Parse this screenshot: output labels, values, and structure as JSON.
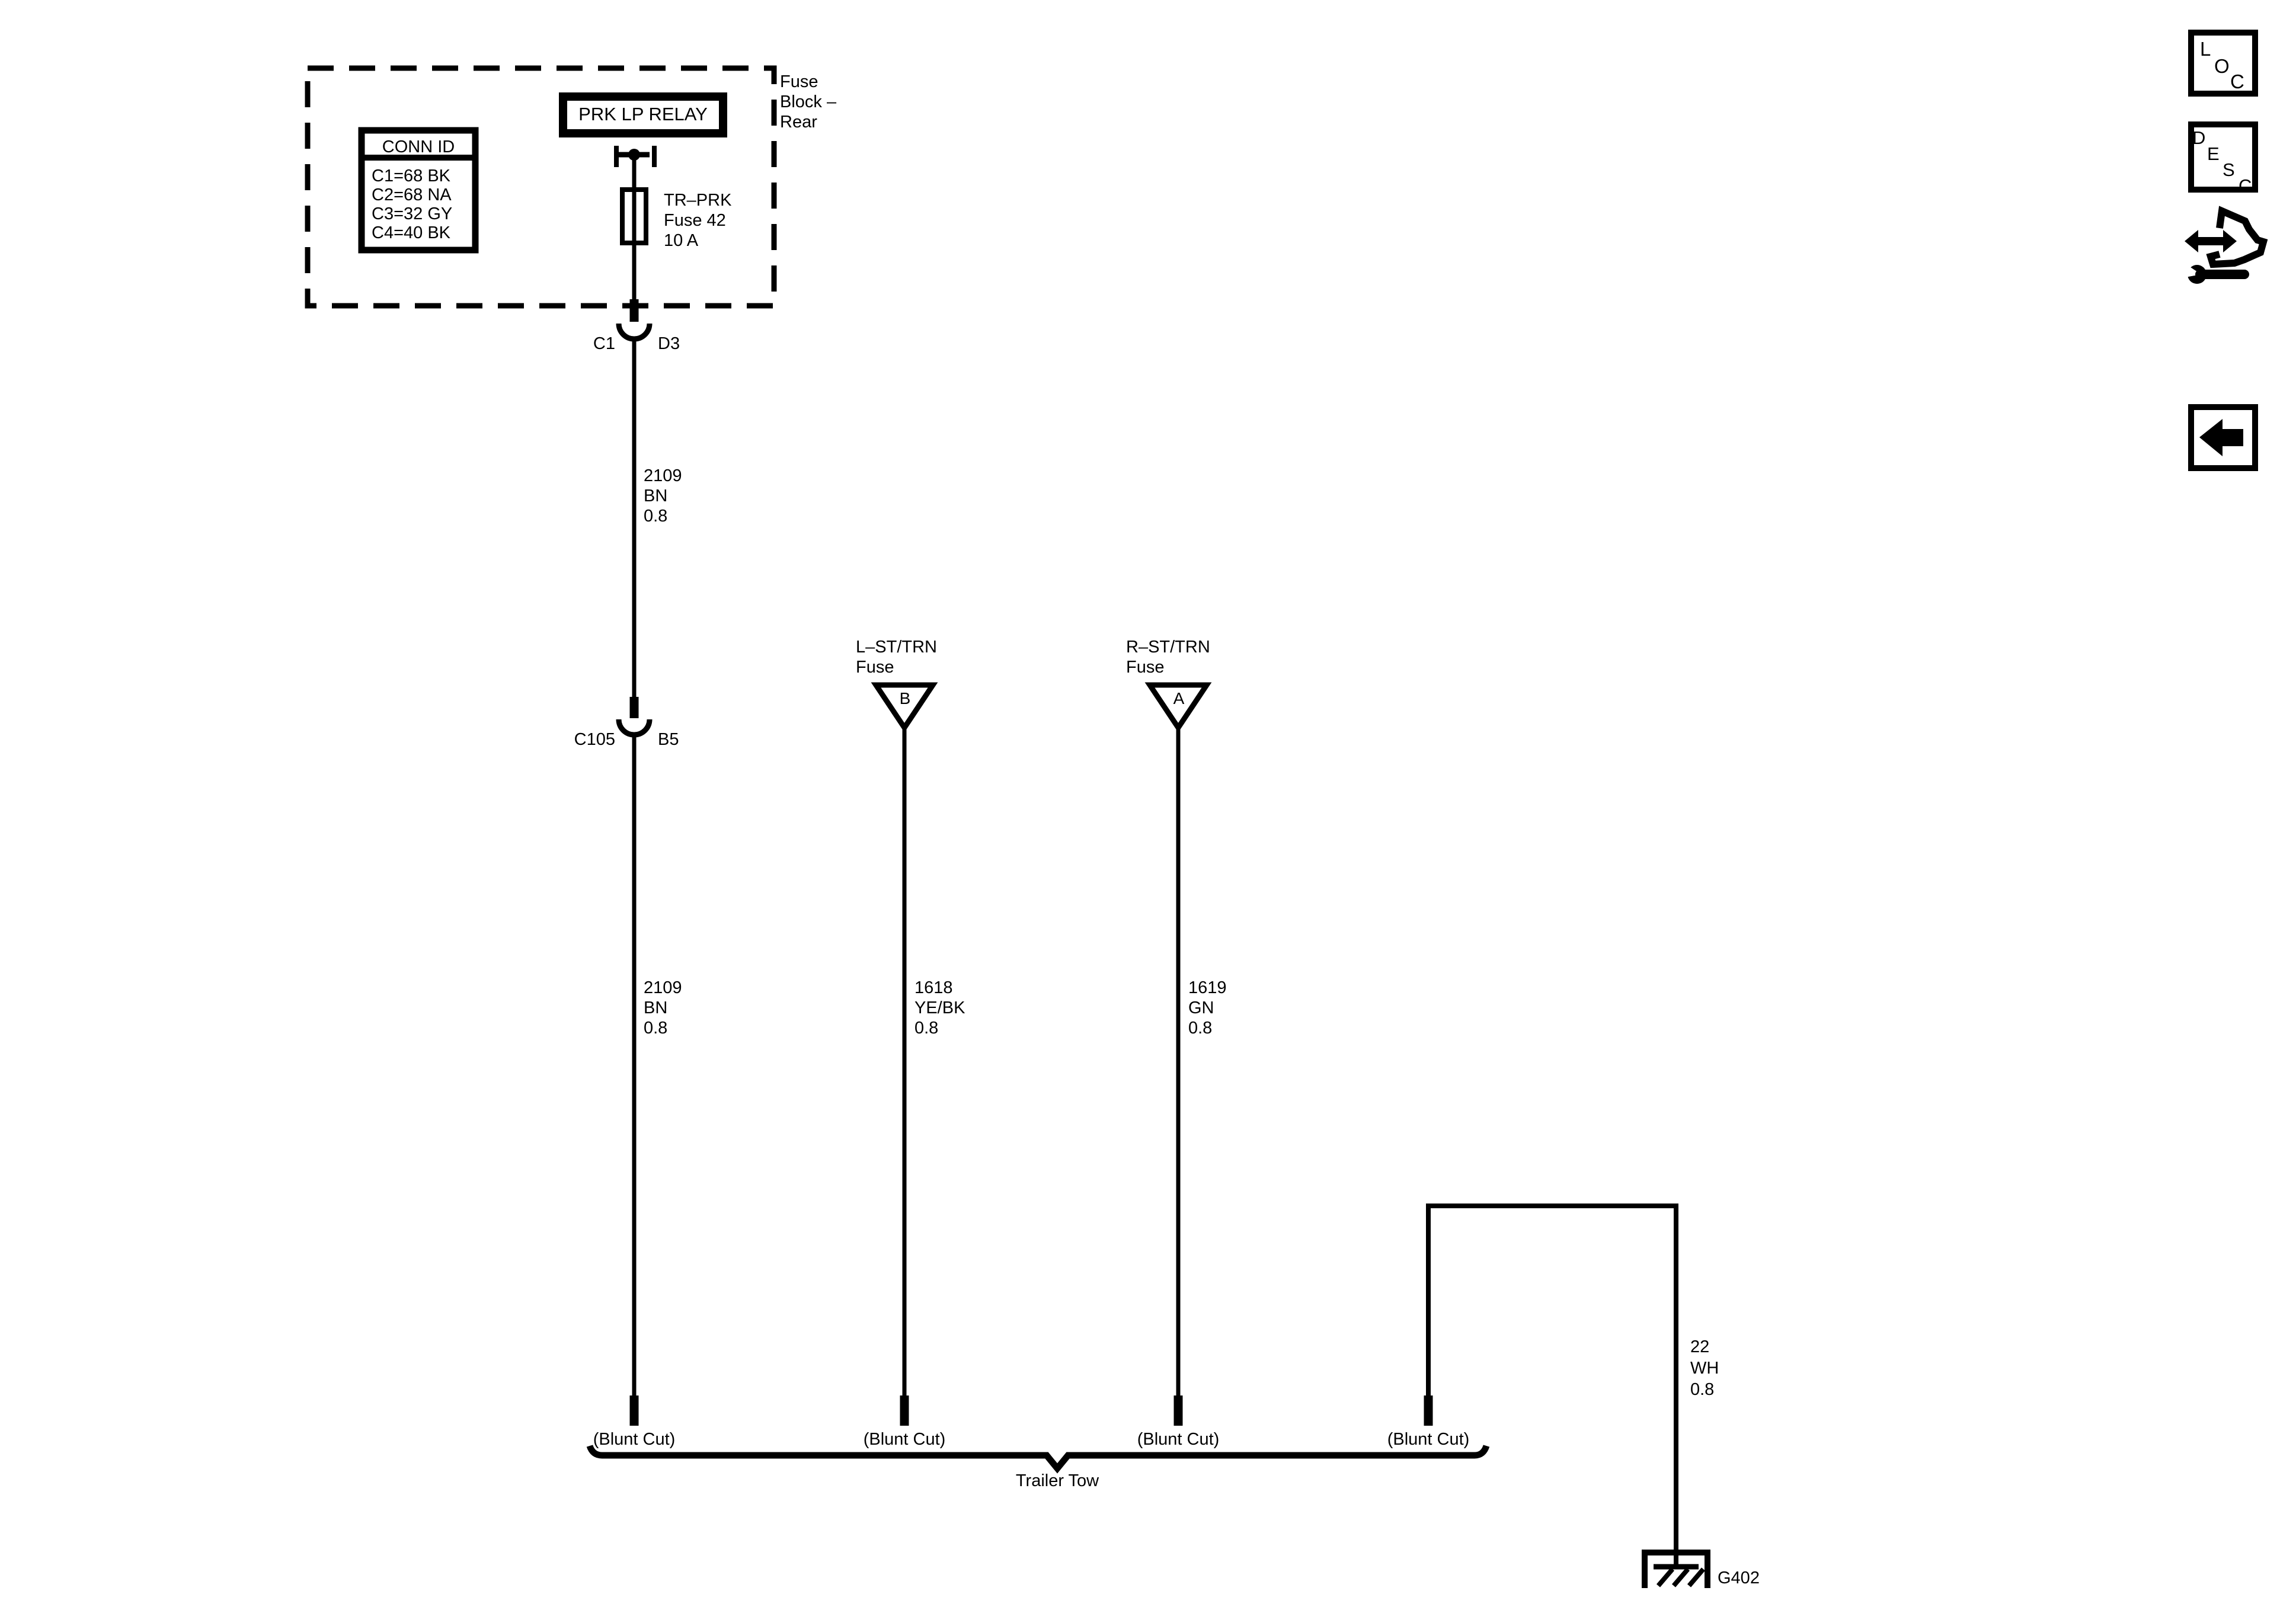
{
  "colors": {
    "ink": "#000000",
    "paper": "#ffffff"
  },
  "fuse_block": {
    "label_lines": [
      "Fuse",
      "Block –",
      "Rear"
    ],
    "relay_label": "PRK LP RELAY",
    "conn_table": {
      "header": "CONN ID",
      "rows": [
        "C1=68 BK",
        "C2=68 NA",
        "C3=32 GY",
        "C4=40 BK"
      ]
    },
    "fuse_lines": [
      "TR–PRK",
      "Fuse 42",
      "10 A"
    ]
  },
  "connectors": {
    "c1": {
      "name": "C1",
      "pin": "D3"
    },
    "c105": {
      "name": "C105",
      "pin": "B5"
    }
  },
  "wires": {
    "seg_2109_upper": [
      "2109",
      "BN",
      "0.8"
    ],
    "seg_2109_lower": [
      "2109",
      "BN",
      "0.8"
    ],
    "seg_1618": [
      "1618",
      "YE/BK",
      "0.8"
    ],
    "seg_1619": [
      "1619",
      "GN",
      "0.8"
    ],
    "seg_22": [
      "22",
      "WH",
      "0.8"
    ]
  },
  "terminals": {
    "left": {
      "lines": [
        "L–ST/TRN",
        "Fuse"
      ],
      "letter": "B"
    },
    "right": {
      "lines": [
        "R–ST/TRN",
        "Fuse"
      ],
      "letter": "A"
    }
  },
  "bottom": {
    "blunt_cuts": [
      "(Blunt Cut)",
      "(Blunt Cut)",
      "(Blunt Cut)",
      "(Blunt Cut)"
    ],
    "harness": "Trailer Tow",
    "ground": "G402"
  },
  "toolbar": {
    "loc": [
      "L",
      "O",
      "C"
    ],
    "desc": [
      "D",
      "E",
      "S",
      "C"
    ]
  }
}
